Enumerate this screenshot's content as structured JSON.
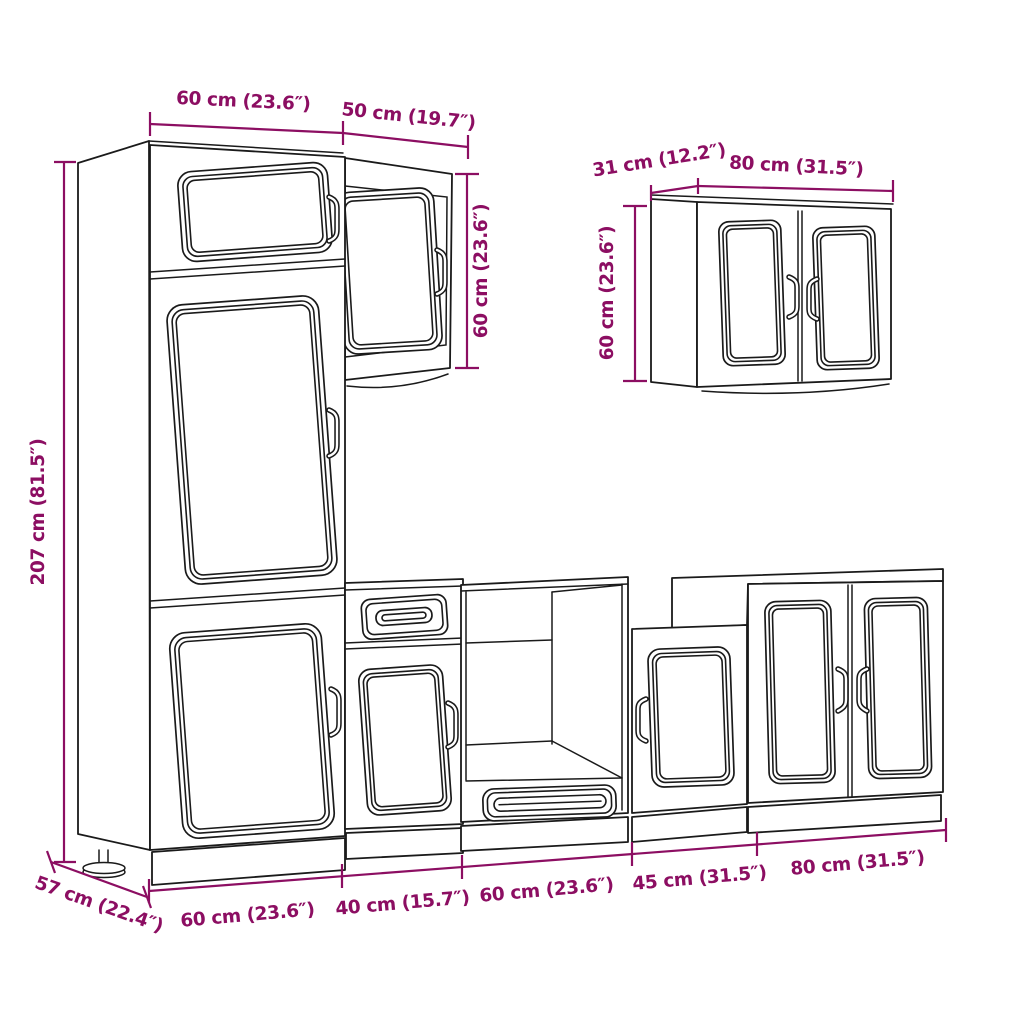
{
  "page": {
    "background": "#ffffff",
    "kind": "furniture dimension diagram",
    "subject": "7-piece kitchen cabinet set line drawing with dimensions"
  },
  "colors": {
    "dimension_text": "#8C0E62",
    "outline": "#1a1a1a"
  },
  "labels": {
    "tall_width": "60 cm (23.6″)",
    "wall50_width": "50 cm (19.7″)",
    "wall50_height": "60 cm (23.6″)",
    "wall80_depth": "31 cm (12.2″)",
    "wall80_width": "80 cm (31.5″)",
    "wall80_height": "60 cm (23.6″)",
    "tall_height": "207 cm (81.5″)",
    "tall_depth": "57 cm (22.4″)",
    "base_60a": "60 cm (23.6″)",
    "base_40": "40 cm (15.7″)",
    "base_60b": "60 cm (23.6″)",
    "base_45": "45 cm (31.5″)",
    "base_80": "80 cm (31.5″)"
  }
}
